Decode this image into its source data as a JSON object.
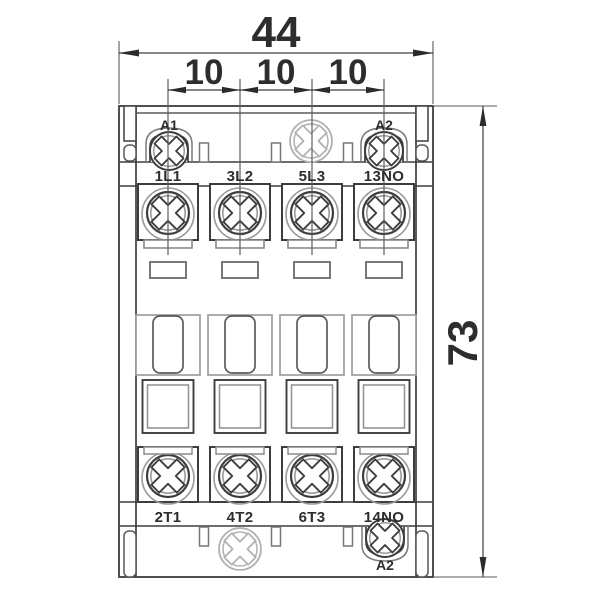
{
  "drawing": {
    "title": "Contactor front view dimension drawing",
    "dimensions": {
      "overall_width_mm": "44",
      "terminal_pitch_mm": [
        "10",
        "10",
        "10"
      ],
      "overall_height_mm": "73"
    },
    "coil_terminals": {
      "top_left": "A1",
      "top_right": "A2",
      "bottom_right": "A2"
    },
    "line_terminals": [
      "1L1",
      "3L2",
      "5L3",
      "13NO"
    ],
    "load_terminals": [
      "2T1",
      "4T2",
      "6T3",
      "14NO"
    ],
    "icons": {
      "terminal_screw": "phillips-screw-icon",
      "coil_screw": "phillips-screw-icon",
      "mounting_screw": "phillips-screw-icon"
    },
    "colors": {
      "background": "#ffffff",
      "line_dark": "#3d3d3d",
      "line_light": "#9e9e9e",
      "dimension": "#2d2d2d"
    }
  }
}
